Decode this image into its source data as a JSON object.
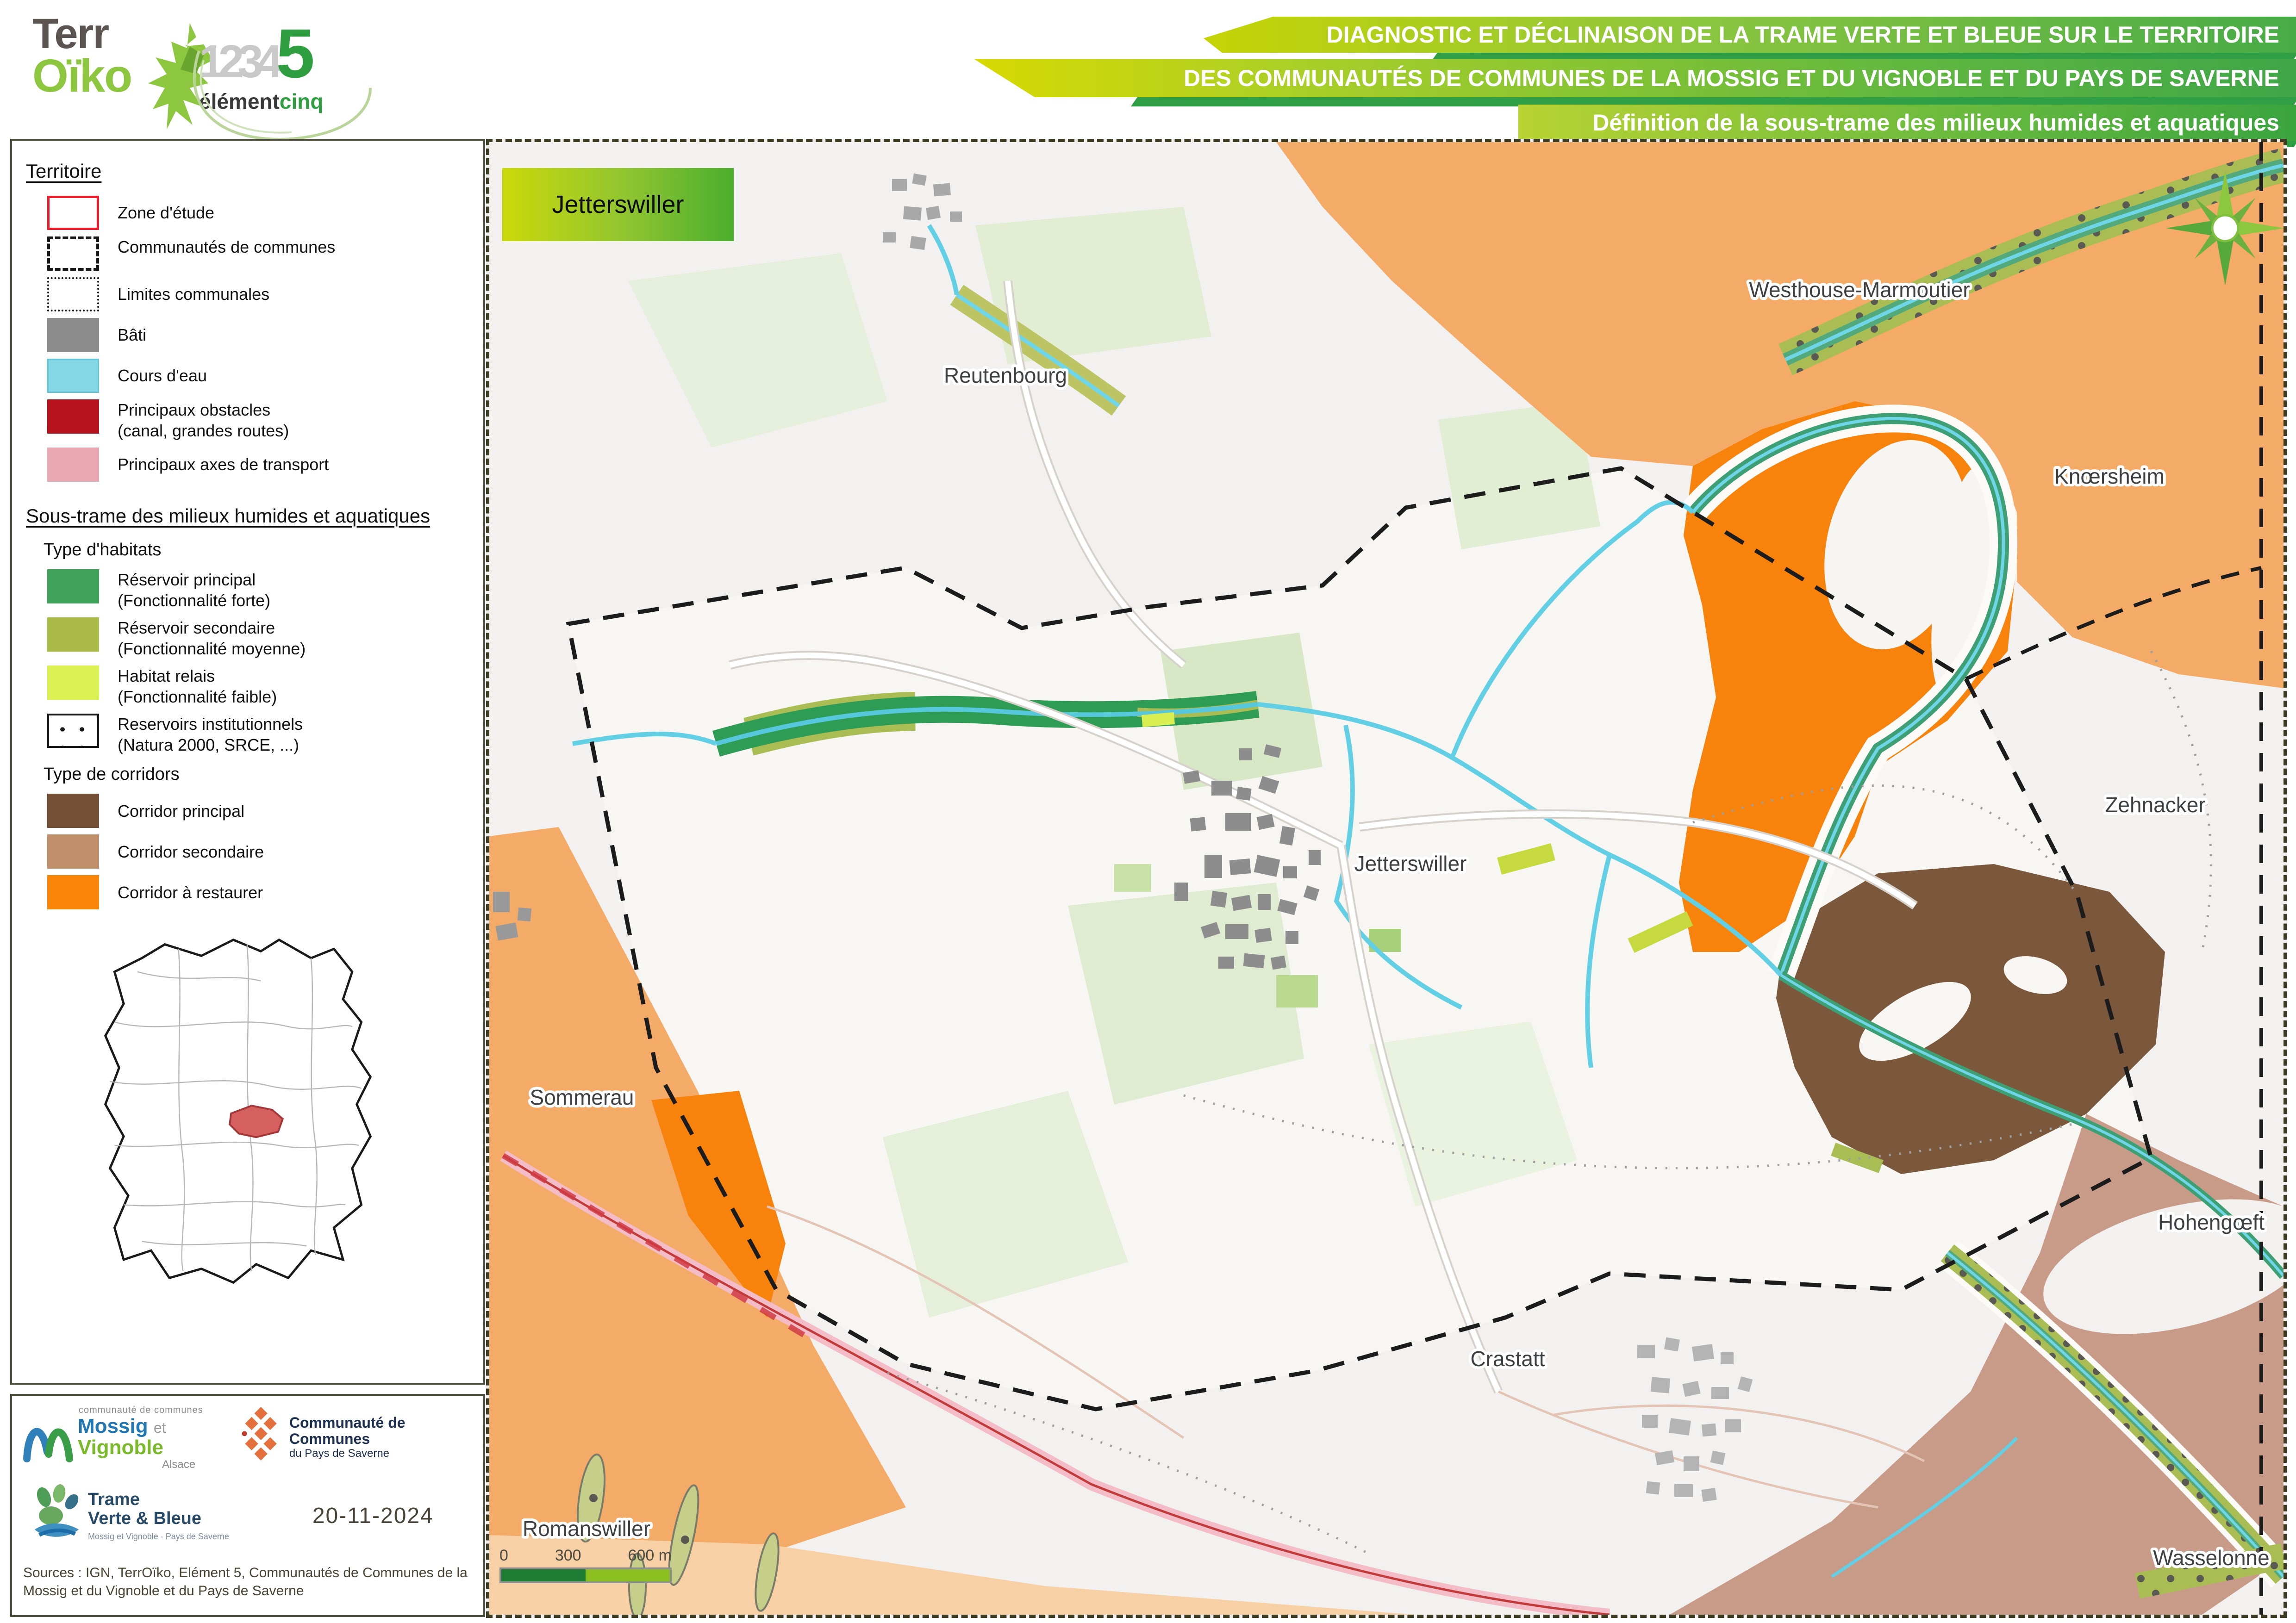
{
  "header": {
    "terroiko": {
      "line1": "Terr",
      "line2": "Oïko"
    },
    "element5": {
      "d1": "1",
      "d2": "2",
      "d3": "3",
      "d4": "4",
      "d5": "5",
      "word1": "élément",
      "word2": "cinq"
    },
    "banner": {
      "line1": "DIAGNOSTIC ET DÉCLINAISON DE LA TRAME VERTE ET BLEUE SUR LE TERRITOIRE",
      "line2": "DES COMMUNAUTÉS DE COMMUNES DE LA MOSSIG ET DU VIGNOBLE ET DU PAYS DE SAVERNE",
      "line3": "Définition de la sous-trame des milieux humides et aquatiques"
    }
  },
  "legend": {
    "territoire": {
      "title": "Territoire",
      "items": [
        {
          "label": "Zone d'étude",
          "color": "#ec1c2d"
        },
        {
          "label": "Communautés de communes",
          "color": "#1a1a1a"
        },
        {
          "label": "Limites communales",
          "color": "#1a1a1a"
        },
        {
          "label": "Bâti",
          "color": "#8c8c8c"
        },
        {
          "label": "Cours d'eau",
          "color": "#84d8e6"
        },
        {
          "label": "Principaux obstacles",
          "sublabel": "(canal, grandes routes)",
          "color": "#b5121b"
        },
        {
          "label": "Principaux axes de transport",
          "color": "#eba9b4"
        }
      ]
    },
    "sous_trame": {
      "title": "Sous-trame des milieux humides et aquatiques",
      "habitats_title": "Type d'habitats",
      "habitats": [
        {
          "label": "Réservoir principal",
          "sublabel": "(Fonctionnalité forte)",
          "color": "#3fa35c"
        },
        {
          "label": "Réservoir secondaire",
          "sublabel": "(Fonctionnalité moyenne)",
          "color": "#a9ba47"
        },
        {
          "label": "Habitat relais",
          "sublabel": "(Fonctionnalité faible)",
          "color": "#dcf153"
        },
        {
          "label": "Reservoirs institutionnels",
          "sublabel": "(Natura 2000, SRCE, ...)",
          "color": "#1a1a1a"
        }
      ],
      "corridors_title": "Type de corridors",
      "corridors": [
        {
          "label": "Corridor principal",
          "color": "#734f35"
        },
        {
          "label": "Corridor secondaire",
          "color": "#c18f69"
        },
        {
          "label": "Corridor à restaurer",
          "color": "#fb8508"
        }
      ]
    }
  },
  "footer": {
    "mossig": {
      "small": "communauté de communes",
      "n1": "Mossig",
      "n2": "et",
      "n3": "Vignoble",
      "region": "Alsace"
    },
    "saverne": {
      "line1": "Communauté de Communes",
      "line2": "du Pays de Saverne"
    },
    "tvb": {
      "line1": "Trame",
      "line2": "Verte & Bleue",
      "sub": "Mossig et Vignoble - Pays de Saverne"
    },
    "date": "20-11-2024",
    "sources": "Sources : IGN, TerrOïko, Elément 5, Communautés de Communes de la Mossig et du Vignoble et du Pays de Saverne"
  },
  "map": {
    "title_box": "Jetterswiller",
    "labels": [
      "Reutenbourg",
      "Westhouse-Marmoutier",
      "Knœrsheim",
      "Zehnacker",
      "Jetterswiller",
      "Sommerau",
      "Crastatt",
      "Hohengœft",
      "Wasselonne",
      "Romanswiller"
    ],
    "scalebar": {
      "zero": "0",
      "mid": "300",
      "end": "600 m"
    }
  },
  "colors": {
    "banner_green_light": "#c6d405",
    "banner_green_dark": "#3fa648",
    "banner_streak": "#2f9e44",
    "map_bg": "#f2f1ef",
    "corridor_restaurer": "#f8830c",
    "corridor_secondaire_orange": "#f4ab67",
    "corridor_secondaire_rose": "#c89b89",
    "corridor_principal": "#7b583c",
    "reservoir_principal": "#2f9c55",
    "reservoir_secondaire": "#aabd55",
    "habitat_relais": "#d9ee51",
    "cours_eau": "#62cfe4",
    "bati": "#8d8d8d",
    "transport_rose": "#f3bcc6",
    "zone_etude_red": "#ec1c2d"
  }
}
